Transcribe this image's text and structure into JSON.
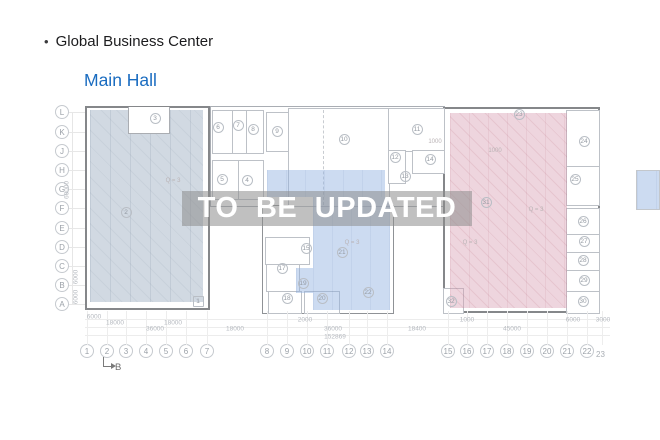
{
  "header": {
    "bullet": "•",
    "title": "Global Business Center",
    "subtitle": "Main Hall"
  },
  "watermark": {
    "text": "TO BE UPDATED"
  },
  "colors": {
    "subtitle_blue": "#1a6cc0",
    "region_left_fill": "rgba(164,180,198,0.50)",
    "region_mid_fill": "rgba(142,176,224,0.45)",
    "region_right_fill": "rgba(214,156,176,0.42)",
    "watermark_band": "rgba(140,140,140,0.55)",
    "watermark_text": "#ffffff"
  },
  "plan": {
    "section_marker": "B",
    "row_labels": [
      {
        "label": "L",
        "y": 112
      },
      {
        "label": "K",
        "y": 132
      },
      {
        "label": "J",
        "y": 151
      },
      {
        "label": "H",
        "y": 170
      },
      {
        "label": "G",
        "y": 189
      },
      {
        "label": "F",
        "y": 208
      },
      {
        "label": "E",
        "y": 228
      },
      {
        "label": "D",
        "y": 247
      },
      {
        "label": "C",
        "y": 266
      },
      {
        "label": "B",
        "y": 285
      },
      {
        "label": "A",
        "y": 304
      }
    ],
    "col_labels": [
      {
        "label": "1",
        "x": 87
      },
      {
        "label": "2",
        "x": 107
      },
      {
        "label": "3",
        "x": 126
      },
      {
        "label": "4",
        "x": 146
      },
      {
        "label": "5",
        "x": 166
      },
      {
        "label": "6",
        "x": 186
      },
      {
        "label": "7",
        "x": 207
      },
      {
        "label": "8",
        "x": 267
      },
      {
        "label": "9",
        "x": 287
      },
      {
        "label": "10",
        "x": 307
      },
      {
        "label": "11",
        "x": 327
      },
      {
        "label": "12",
        "x": 349
      },
      {
        "label": "13",
        "x": 367
      },
      {
        "label": "14",
        "x": 387
      },
      {
        "label": "15",
        "x": 448
      },
      {
        "label": "16",
        "x": 467
      },
      {
        "label": "17",
        "x": 487
      },
      {
        "label": "18",
        "x": 507
      },
      {
        "label": "19",
        "x": 527
      },
      {
        "label": "20",
        "x": 547
      },
      {
        "label": "21",
        "x": 567
      },
      {
        "label": "22",
        "x": 587
      },
      {
        "label": "23",
        "x": 602,
        "y": 355,
        "plain": true
      }
    ],
    "rooms": [
      {
        "n": "1",
        "x": 198,
        "y": 301,
        "boxed": true
      },
      {
        "n": "2",
        "x": 126,
        "y": 212
      },
      {
        "n": "3",
        "x": 155,
        "y": 118
      },
      {
        "n": "4",
        "x": 247,
        "y": 180
      },
      {
        "n": "5",
        "x": 222,
        "y": 179
      },
      {
        "n": "6",
        "x": 218,
        "y": 127
      },
      {
        "n": "7",
        "x": 238,
        "y": 125
      },
      {
        "n": "8",
        "x": 253,
        "y": 129
      },
      {
        "n": "9",
        "x": 277,
        "y": 131
      },
      {
        "n": "10",
        "x": 344,
        "y": 139
      },
      {
        "n": "11",
        "x": 417,
        "y": 129
      },
      {
        "n": "12",
        "x": 395,
        "y": 157
      },
      {
        "n": "13",
        "x": 405,
        "y": 176
      },
      {
        "n": "14",
        "x": 430,
        "y": 159
      },
      {
        "n": "15",
        "x": 306,
        "y": 248
      },
      {
        "n": "17",
        "x": 282,
        "y": 268
      },
      {
        "n": "18",
        "x": 287,
        "y": 298
      },
      {
        "n": "19",
        "x": 303,
        "y": 283
      },
      {
        "n": "20",
        "x": 322,
        "y": 298
      },
      {
        "n": "21",
        "x": 342,
        "y": 252
      },
      {
        "n": "22",
        "x": 368,
        "y": 292
      },
      {
        "n": "23",
        "x": 519,
        "y": 114
      },
      {
        "n": "24",
        "x": 584,
        "y": 141
      },
      {
        "n": "25",
        "x": 575,
        "y": 179
      },
      {
        "n": "26",
        "x": 583,
        "y": 221
      },
      {
        "n": "27",
        "x": 584,
        "y": 241
      },
      {
        "n": "28",
        "x": 583,
        "y": 260
      },
      {
        "n": "29",
        "x": 584,
        "y": 280
      },
      {
        "n": "30",
        "x": 583,
        "y": 301
      },
      {
        "n": "31",
        "x": 486,
        "y": 202
      },
      {
        "n": "32",
        "x": 451,
        "y": 301
      }
    ],
    "dims": [
      {
        "v": "6000",
        "x": 94,
        "y": 317
      },
      {
        "v": "18000",
        "x": 115,
        "y": 323
      },
      {
        "v": "36000",
        "x": 155,
        "y": 329
      },
      {
        "v": "18000",
        "x": 173,
        "y": 323
      },
      {
        "v": "18000",
        "x": 235,
        "y": 329
      },
      {
        "v": "2000",
        "x": 305,
        "y": 320
      },
      {
        "v": "36000",
        "x": 333,
        "y": 329
      },
      {
        "v": "152869",
        "x": 335,
        "y": 337
      },
      {
        "v": "18400",
        "x": 417,
        "y": 329
      },
      {
        "v": "1000",
        "x": 467,
        "y": 320
      },
      {
        "v": "45000",
        "x": 512,
        "y": 329
      },
      {
        "v": "6000",
        "x": 573,
        "y": 320
      },
      {
        "v": "3000",
        "x": 603,
        "y": 320
      }
    ],
    "notes": [
      {
        "t": "Q = 3",
        "x": 173,
        "y": 181
      },
      {
        "t": "Q = 3",
        "x": 352,
        "y": 243
      },
      {
        "t": "Q = 3",
        "x": 536,
        "y": 210
      },
      {
        "t": "Q = 3",
        "x": 470,
        "y": 243
      },
      {
        "t": "1000",
        "x": 435,
        "y": 142
      },
      {
        "t": "1000",
        "x": 495,
        "y": 151
      },
      {
        "t": "60000",
        "x": 67,
        "y": 190,
        "rot": true
      },
      {
        "t": "6000",
        "x": 76,
        "y": 277,
        "rot": true
      },
      {
        "t": "6000",
        "x": 76,
        "y": 297,
        "rot": true
      }
    ]
  }
}
